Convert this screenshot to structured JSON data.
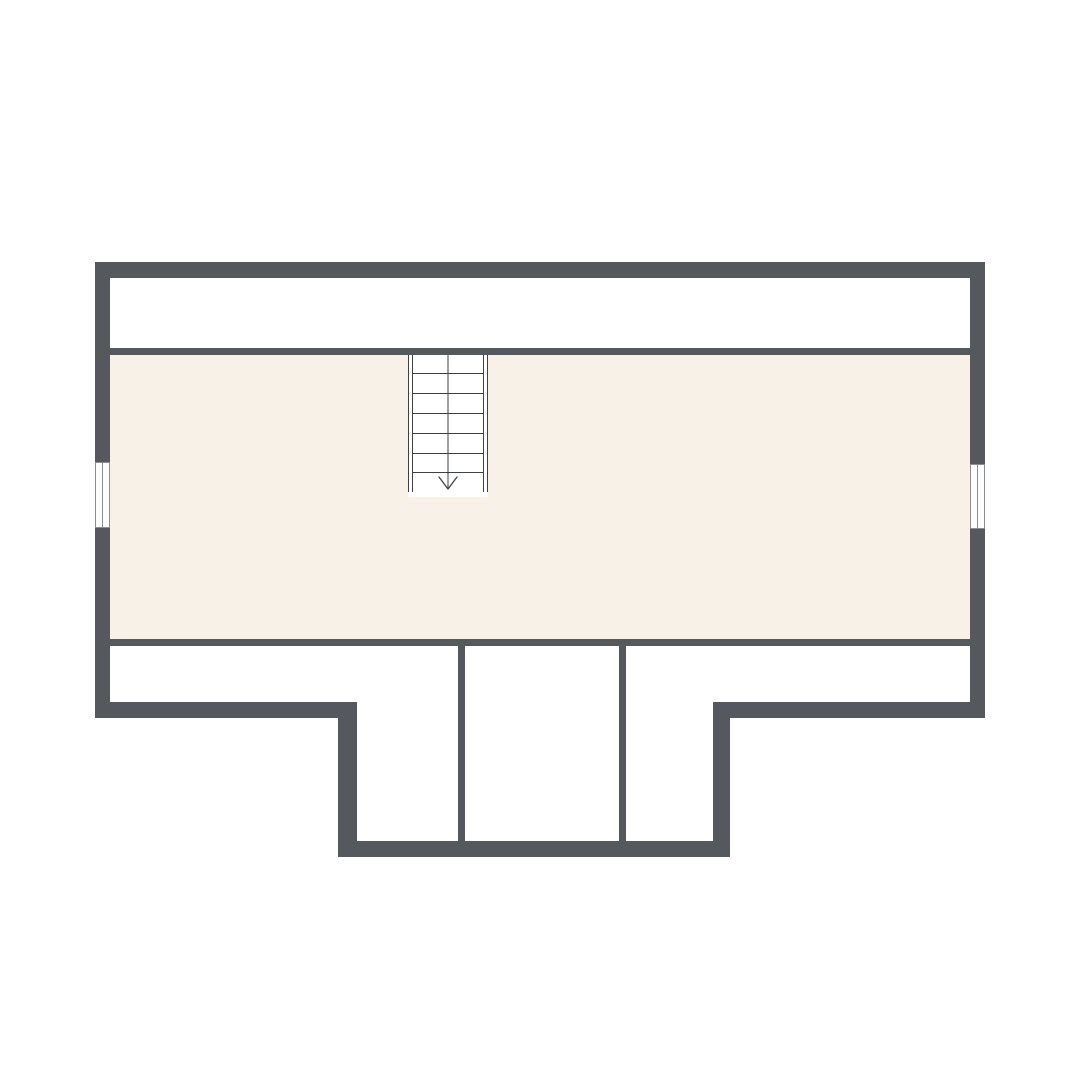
{
  "page": {
    "background": "#ffffff",
    "width": 1080,
    "height": 1080,
    "description": "attic-floor-plan"
  },
  "palette": {
    "wall": "#55585c",
    "room_fill": "#f7f1e8",
    "void_fill": "#ffffff",
    "stair_line": "#3e4144",
    "window_line": "#8b8e91",
    "white": "#ffffff"
  },
  "floorplan": {
    "fills": [
      {
        "name": "north-eaves-strip",
        "x": 110,
        "y": 278,
        "w": 860,
        "h": 70,
        "color": "void_fill"
      },
      {
        "name": "main-attic-room",
        "x": 110,
        "y": 355,
        "w": 860,
        "h": 284,
        "color": "room_fill"
      }
    ],
    "walls": [
      {
        "name": "exterior-wall-north",
        "x": 95,
        "y": 262,
        "w": 890,
        "h": 16
      },
      {
        "name": "exterior-wall-west",
        "x": 95,
        "y": 262,
        "w": 15,
        "h": 456
      },
      {
        "name": "exterior-wall-east",
        "x": 970,
        "y": 262,
        "w": 15,
        "h": 456
      },
      {
        "name": "exterior-wall-south-west-segment",
        "x": 95,
        "y": 702,
        "w": 262,
        "h": 16
      },
      {
        "name": "exterior-wall-south-east-segment",
        "x": 713,
        "y": 702,
        "w": 272,
        "h": 16
      },
      {
        "name": "bump-out-wall-west",
        "x": 338,
        "y": 702,
        "w": 19,
        "h": 155
      },
      {
        "name": "bump-out-wall-east",
        "x": 713,
        "y": 702,
        "w": 17,
        "h": 155
      },
      {
        "name": "bump-out-wall-south",
        "x": 338,
        "y": 841,
        "w": 392,
        "h": 16
      },
      {
        "name": "knee-wall-north",
        "x": 110,
        "y": 348,
        "w": 860,
        "h": 7
      },
      {
        "name": "room-wall-south",
        "x": 110,
        "y": 639,
        "w": 860,
        "h": 7
      },
      {
        "name": "partition-wall-west",
        "x": 458,
        "y": 646,
        "w": 7,
        "h": 195
      },
      {
        "name": "partition-wall-east",
        "x": 619,
        "y": 646,
        "w": 7,
        "h": 195
      }
    ],
    "windows": [
      {
        "name": "window-west",
        "x": 95,
        "y": 462,
        "w": 15,
        "h": 66
      },
      {
        "name": "window-east",
        "x": 970,
        "y": 464,
        "w": 15,
        "h": 65
      }
    ],
    "stairs": {
      "name": "staircase",
      "x": 408,
      "y": 355,
      "w": 80,
      "h": 142,
      "stringer_w": 5,
      "rail_bottom": 492,
      "tread_ys": [
        373,
        393,
        413,
        433,
        453,
        472
      ],
      "center_x": 448,
      "arrow": {
        "direction": "down",
        "head_top": 477,
        "tip_y": 489,
        "half_w": 9
      }
    }
  }
}
